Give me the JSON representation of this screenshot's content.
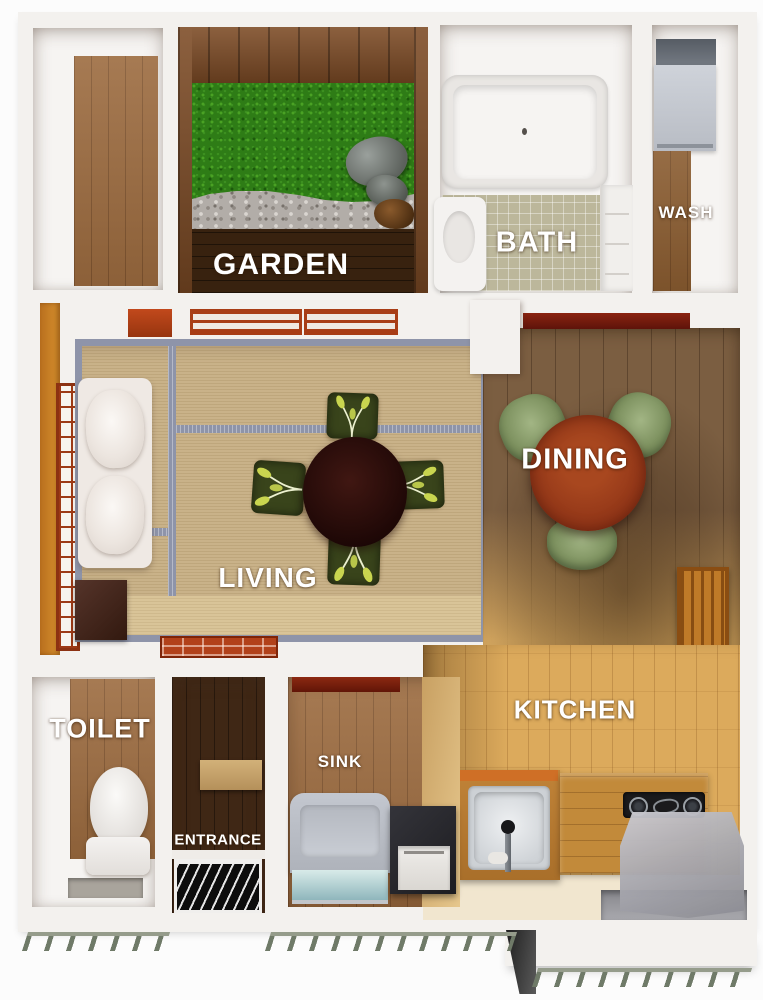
{
  "plan": {
    "type": "3D apartment floor plan, top-down view"
  },
  "rooms": {
    "garden": {
      "label": "GARDEN"
    },
    "bath": {
      "label": "BATH"
    },
    "wash": {
      "label": "WASH"
    },
    "living": {
      "label": "LIVING"
    },
    "dining": {
      "label": "DINING"
    },
    "toilet": {
      "label": "TOILET"
    },
    "entrance": {
      "label": "ENTRANCE"
    },
    "sink": {
      "label": "SINK"
    },
    "kitchen": {
      "label": "KITCHEN"
    }
  },
  "palette": {
    "wall_white": "#f3f1ee",
    "tatami": "#c9b289",
    "tatami_border": "#8e94a9",
    "grass_green": "#2e7c16",
    "gravel_gray": "#b2ada8",
    "deck_dark_brown": "#38220f",
    "wood_floor": "#9c6b3f",
    "kitchen_wood": "#dcaa5c",
    "dining_wood": "#7b5e41",
    "accent_red": "#a83d16",
    "dining_table_red": "#93391b",
    "chair_green": "#85996a",
    "living_table_brown": "#2a100e",
    "appliance_gray": "#b7bbc3",
    "stove_black": "#1a1a1c",
    "label_text": "#ffffff"
  }
}
